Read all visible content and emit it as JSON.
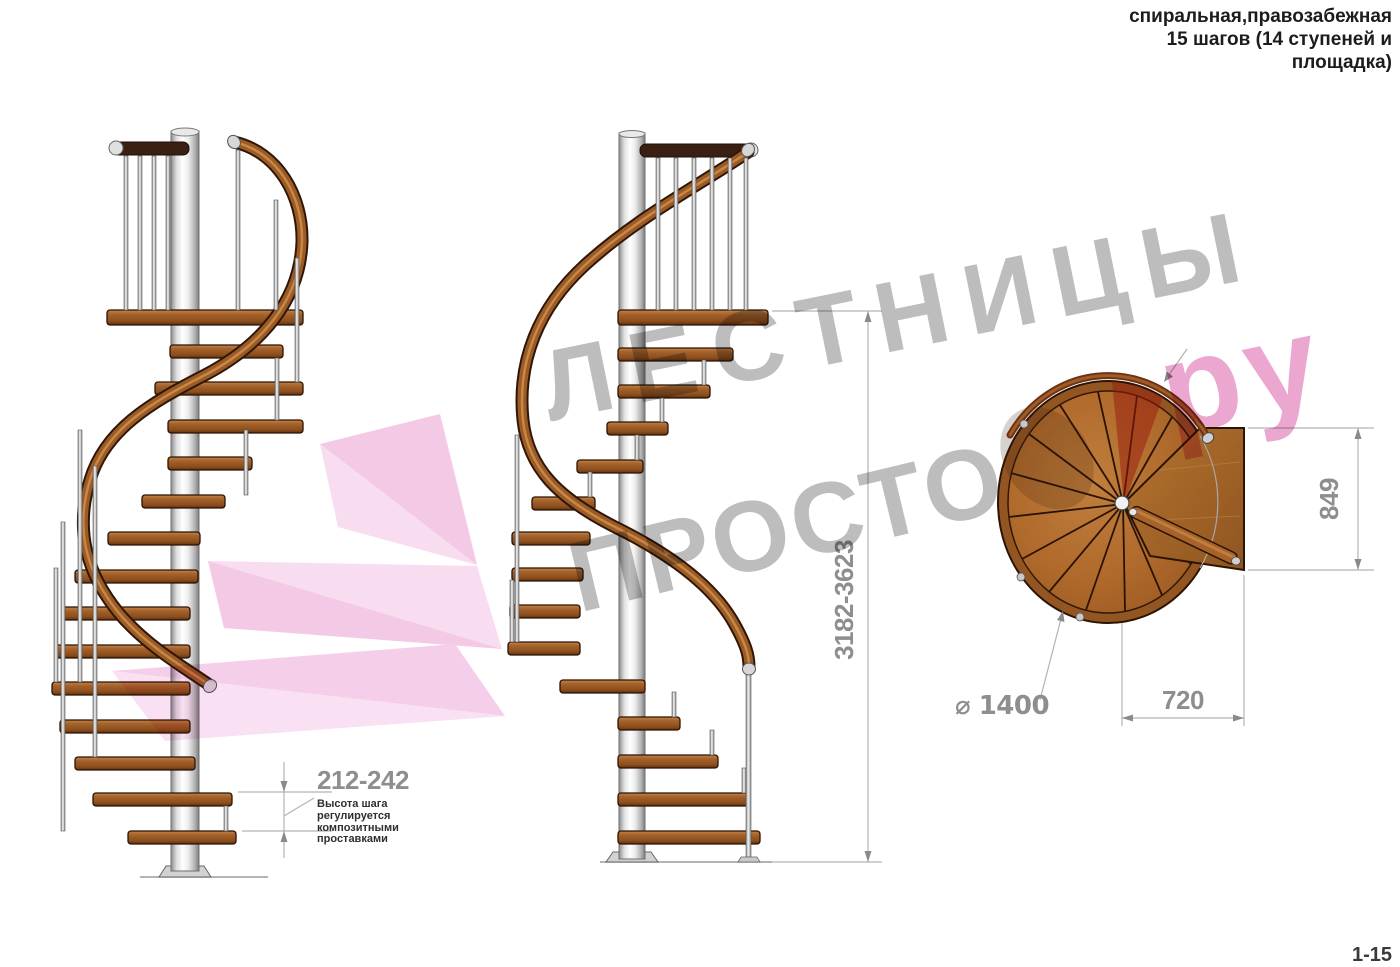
{
  "title": {
    "text": "спиральная,правозабежная\n15 шагов (14 ступеней и\nплощадка)"
  },
  "dimensions": {
    "step_height": "212-242",
    "total_height": "3182-3623",
    "platform_depth": "849",
    "platform_width": "720",
    "diameter": "⌀ 1400"
  },
  "annotation": {
    "text": "Высота шага\nрегулируется\nкомпозитными\nпроставками"
  },
  "watermark": {
    "line1": "ЛЕСТНИЦЫ",
    "line2": "ПРОСТО",
    "accent": "ру"
  },
  "footer": {
    "sheet_ref": "1-15"
  },
  "colors": {
    "dim_text_gray": "#8e8e8e",
    "dim_line_gray": "#b3b3b3",
    "annotation_dark": "#2f2f2f",
    "watermark_gray": "#bdbdbd",
    "watermark_pink": "#eba7cf",
    "ribbon_pink": "#f5cfe9",
    "wood_brown": "#a4622b",
    "wood_dark_edge": "#2a1305",
    "metal_light": "#d8d8d8"
  }
}
